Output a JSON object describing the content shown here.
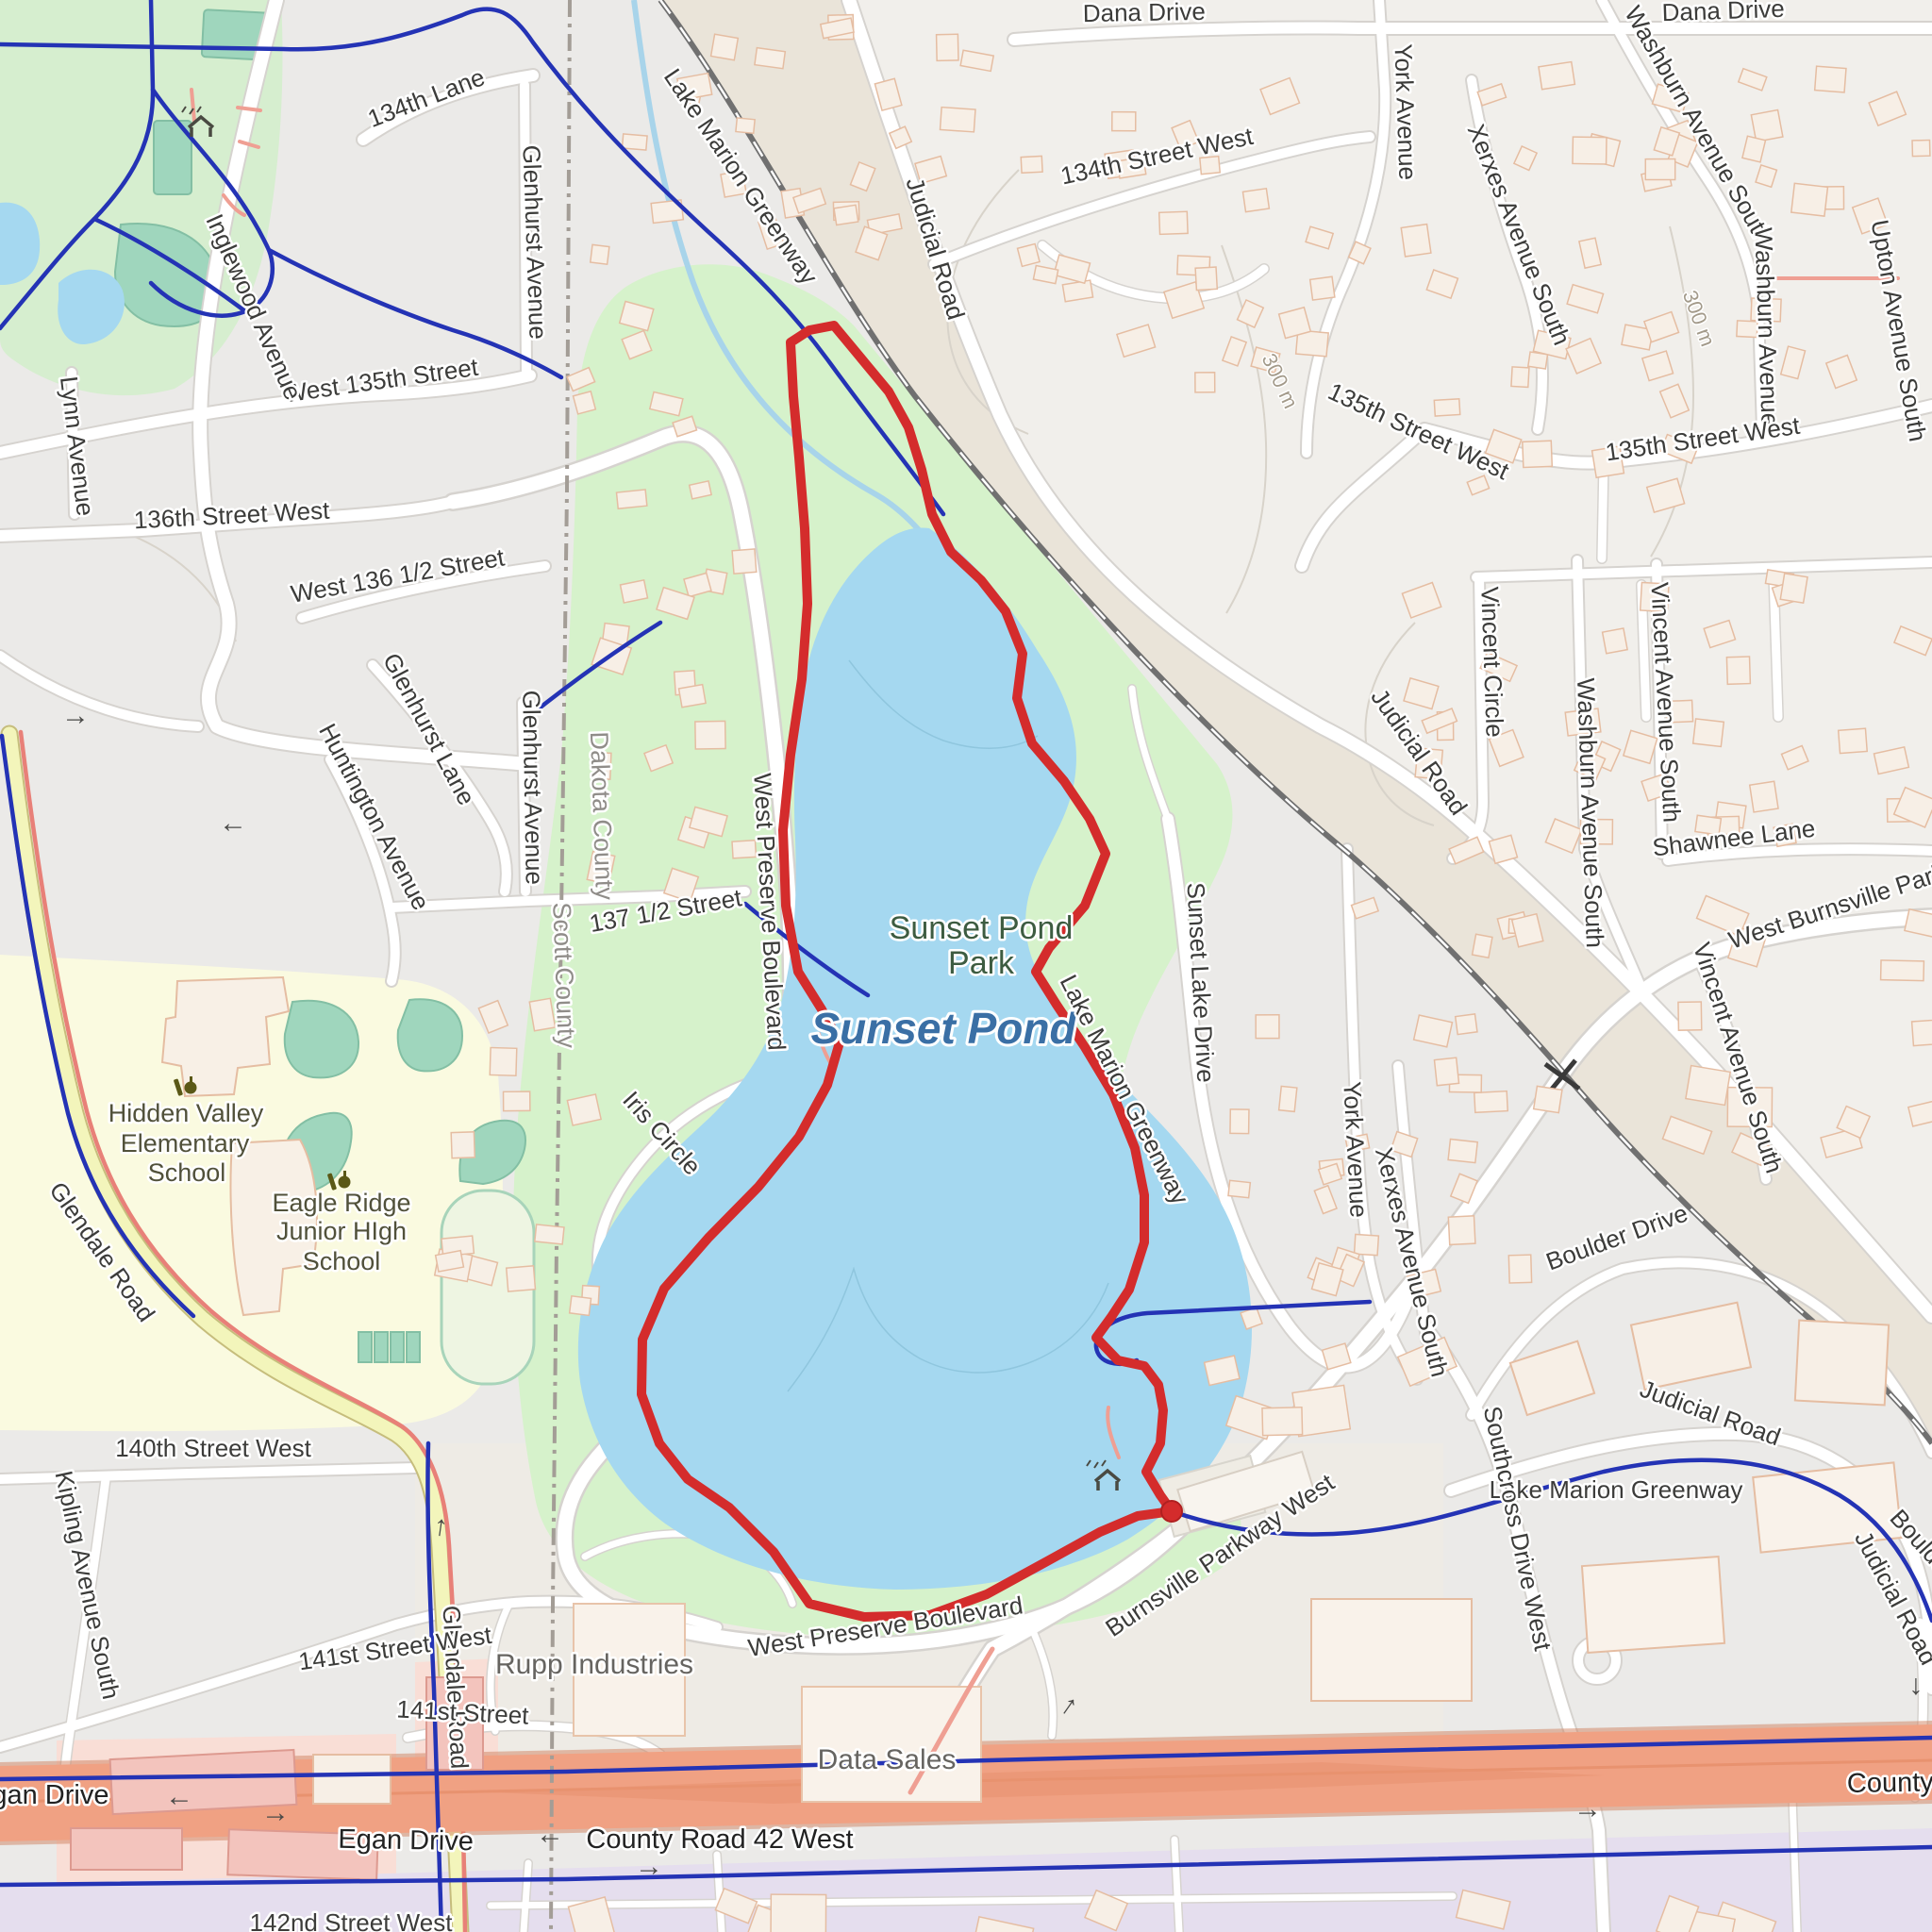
{
  "labels": {
    "dana_drive": "Dana Drive",
    "lane_134th": "134th Lane",
    "street_134th_west": "134th Street West",
    "west_135th_street": "West 135th Street",
    "street_135th_west": "135th Street West",
    "street_136th_west": "136th Street West",
    "west_136_half_street": "West 136 1/2 Street",
    "street_137_half": "137 1/2 Street",
    "street_140th_west": "140th Street West",
    "street_141st_west": "141st Street West",
    "street_141st": "141st Street",
    "street_142nd_west": "142nd Street West",
    "york_avenue": "York Avenue",
    "xerxes_avenue_south": "Xerxes Avenue South",
    "washburn_avenue_south": "Washburn Avenue South",
    "washburn_avenue": "Washburn Avenue",
    "upton_avenue_south": "Upton Avenue South",
    "vincent_circle": "Vincent Circle",
    "vincent_avenue_south": "Vincent Avenue South",
    "shawnee_lane": "Shawnee Lane",
    "boulder_drive": "Boulder Drive",
    "judicial_road": "Judicial Road",
    "lake_marion_greenway": "Lake Marion Greenway",
    "inglewood_avenue": "Inglewood Avenue",
    "lynn_avenue": "Lynn Avenue",
    "glenhurst_lane": "Glenhurst Lane",
    "glenhurst_avenue": "Glenhurst Avenue",
    "huntington_avenue": "Huntington Avenue",
    "iris_circle": "Iris Circle",
    "west_preserve_boulevard": "West Preserve Boulevard",
    "sunset_lake_drive": "Sunset Lake Drive",
    "burnsville_parkway_west": "Burnsville Parkway West",
    "west_burnsville_parkway": "West Burnsville Parkway",
    "southcross_drive_west": "Southcross Drive West",
    "county_road_42_west": "County Road 42 West",
    "egan_drive": "Egan Drive",
    "glendale_road": "Glendale Road",
    "kipling_avenue_south": "Kipling Avenue South",
    "dakota_county": "Dakota County",
    "scott_county": "Scott County",
    "sunset_pond_park_line1": "Sunset Pond",
    "sunset_pond_park_line2": "Park",
    "sunset_pond": "Sunset Pond",
    "hidden_valley_line1": "Hidden Valley",
    "hidden_valley_line2": "Elementary",
    "hidden_valley_line3": "School",
    "eagle_ridge_line1": "Eagle Ridge",
    "eagle_ridge_line2": "Junior HIgh",
    "eagle_ridge_line3": "School",
    "rupp_industries": "Rupp Industries",
    "data_sales": "Data Sales",
    "contour_300m": "300 m"
  },
  "route": {
    "name": "gps-track-loop-around-sunset-pond",
    "color": "#d42c2c",
    "width": 10,
    "end_marker": [
      1242,
      1602
    ],
    "points": [
      [
        1242,
        1602
      ],
      [
        1230,
        1585
      ],
      [
        1215,
        1560
      ],
      [
        1230,
        1530
      ],
      [
        1233,
        1495
      ],
      [
        1228,
        1468
      ],
      [
        1213,
        1448
      ],
      [
        1185,
        1442
      ],
      [
        1162,
        1418
      ],
      [
        1178,
        1396
      ],
      [
        1197,
        1367
      ],
      [
        1213,
        1317
      ],
      [
        1213,
        1267
      ],
      [
        1203,
        1217
      ],
      [
        1180,
        1160
      ],
      [
        1150,
        1110
      ],
      [
        1120,
        1065
      ],
      [
        1098,
        1030
      ],
      [
        1112,
        1005
      ],
      [
        1150,
        960
      ],
      [
        1172,
        905
      ],
      [
        1155,
        868
      ],
      [
        1128,
        828
      ],
      [
        1094,
        788
      ],
      [
        1078,
        740
      ],
      [
        1084,
        693
      ],
      [
        1066,
        648
      ],
      [
        1040,
        615
      ],
      [
        1008,
        585
      ],
      [
        988,
        545
      ],
      [
        977,
        498
      ],
      [
        963,
        453
      ],
      [
        942,
        415
      ],
      [
        913,
        380
      ],
      [
        884,
        345
      ],
      [
        858,
        350
      ],
      [
        838,
        363
      ],
      [
        841,
        420
      ],
      [
        847,
        485
      ],
      [
        853,
        560
      ],
      [
        856,
        640
      ],
      [
        850,
        720
      ],
      [
        838,
        800
      ],
      [
        830,
        880
      ],
      [
        833,
        960
      ],
      [
        846,
        1030
      ],
      [
        871,
        1070
      ],
      [
        890,
        1105
      ],
      [
        877,
        1150
      ],
      [
        847,
        1205
      ],
      [
        804,
        1258
      ],
      [
        751,
        1312
      ],
      [
        704,
        1366
      ],
      [
        681,
        1420
      ],
      [
        680,
        1478
      ],
      [
        699,
        1530
      ],
      [
        729,
        1568
      ],
      [
        773,
        1598
      ],
      [
        820,
        1645
      ],
      [
        858,
        1700
      ],
      [
        916,
        1714
      ],
      [
        986,
        1712
      ],
      [
        1046,
        1690
      ],
      [
        1110,
        1655
      ],
      [
        1166,
        1624
      ],
      [
        1206,
        1607
      ],
      [
        1242,
        1602
      ]
    ]
  },
  "colors": {
    "water": "#a5d8f0",
    "park_green": "#d6f2cb",
    "school_yellow": "#fafae0",
    "sports_teal": "#9fd6bd",
    "trunk_orange": "#f0a183",
    "secondary_yellow": "#f3f5bb",
    "route_red": "#d42c2c",
    "bike_path_blue": "#2433b5",
    "railway_gray": "#707070",
    "county_boundary_gray": "#a39d96",
    "building_fill": "#f7efe6",
    "commercial_pink": "#f3c4bd",
    "retail_purple": "#e5deee"
  },
  "icons": [
    {
      "name": "school-icon",
      "at": "hidden-valley-elementary"
    },
    {
      "name": "school-icon",
      "at": "eagle-ridge-junior-high"
    },
    {
      "name": "picnic-shelter-icon",
      "at": "sunset-pond-park-trailhead"
    },
    {
      "name": "picnic-shelter-icon",
      "at": "northwest-park"
    }
  ]
}
